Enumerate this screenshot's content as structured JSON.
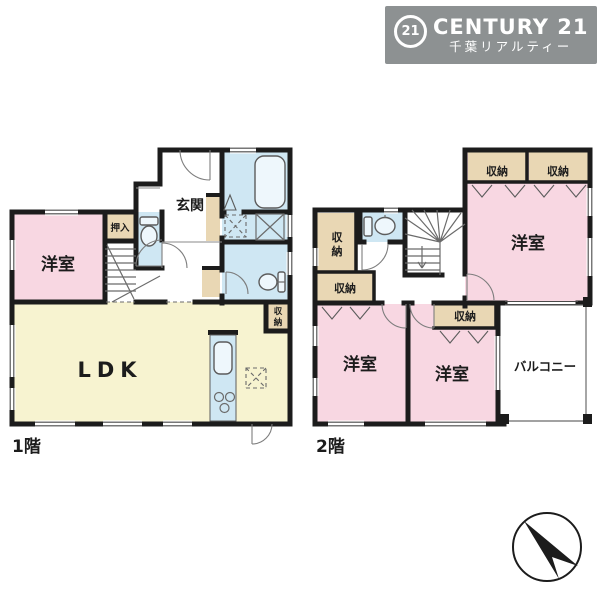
{
  "logo": {
    "mark": "21",
    "brand": "CENTURY 21",
    "subtitle": "千葉リアルティー",
    "bg_color": "#8d9192"
  },
  "labels": {
    "floor1": "1階",
    "floor2": "2階",
    "entrance": "玄関",
    "oshiire": "押入",
    "western_room": "洋室",
    "ldk": "LDK",
    "storage": "収納",
    "storage_char_top": "収",
    "storage_char_bottom": "納",
    "balcony": "バルコニー"
  },
  "colors": {
    "wall": "#1c1c1c",
    "room_pink": "#f8d7e2",
    "room_yellow": "#f7f3d0",
    "water_blue": "#cfe7f3",
    "storage_beige": "#e9d7b4",
    "balcony_white": "#ffffff",
    "logo_bg": "#8d9192"
  }
}
